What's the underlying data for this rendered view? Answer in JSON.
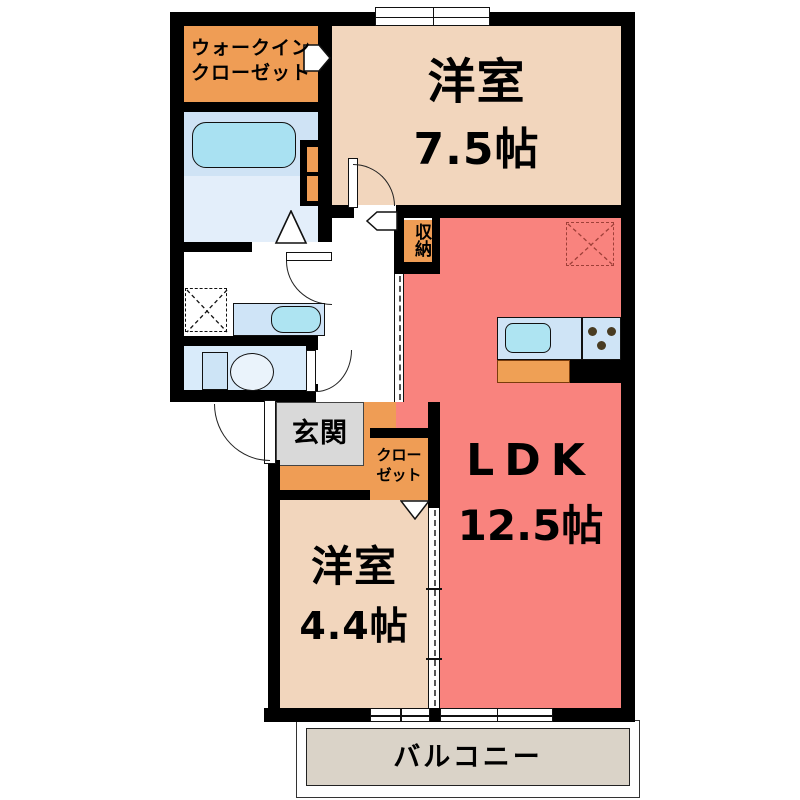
{
  "rooms": {
    "walk_in_closet": {
      "line1": "ウォークイン",
      "line2": "クローゼット"
    },
    "western_room_7_5": {
      "name": "洋室",
      "size": "7.5帖"
    },
    "ldk": {
      "name": "LDK",
      "size": "12.5帖"
    },
    "western_room_4_4": {
      "name": "洋室",
      "size": "4.4帖"
    },
    "entrance": {
      "label": "玄関"
    },
    "closet": {
      "line1": "クロー",
      "line2": "ゼット"
    },
    "storage": {
      "label": "収納"
    },
    "balcony": {
      "label": "バルコニー"
    }
  },
  "fixtures": {
    "bathtub": "bathtub-shape",
    "vanity_sink": "sink-shape",
    "toilet": "toilet-shape",
    "kitchen_counter": "kitchen-counter-with-sink-and-burners",
    "washer_space": "dashed-x-square",
    "fridge_space": "dashed-x-square"
  },
  "colors": {
    "wall": "#000000",
    "room_tan": "#F2D6BD",
    "accent_orange": "#EF9D55",
    "ldk_pink": "#F9837E",
    "water_blue": "#CFE4F7",
    "bath_lower": "#E3EEFA",
    "tub_cyan": "#A9E1F2",
    "entrance_gray": "#D9D9D9",
    "toilet_blue": "#D9EBFA",
    "balcony_gray": "#DAD3C8",
    "fridge_dash": "#9E3F38"
  }
}
